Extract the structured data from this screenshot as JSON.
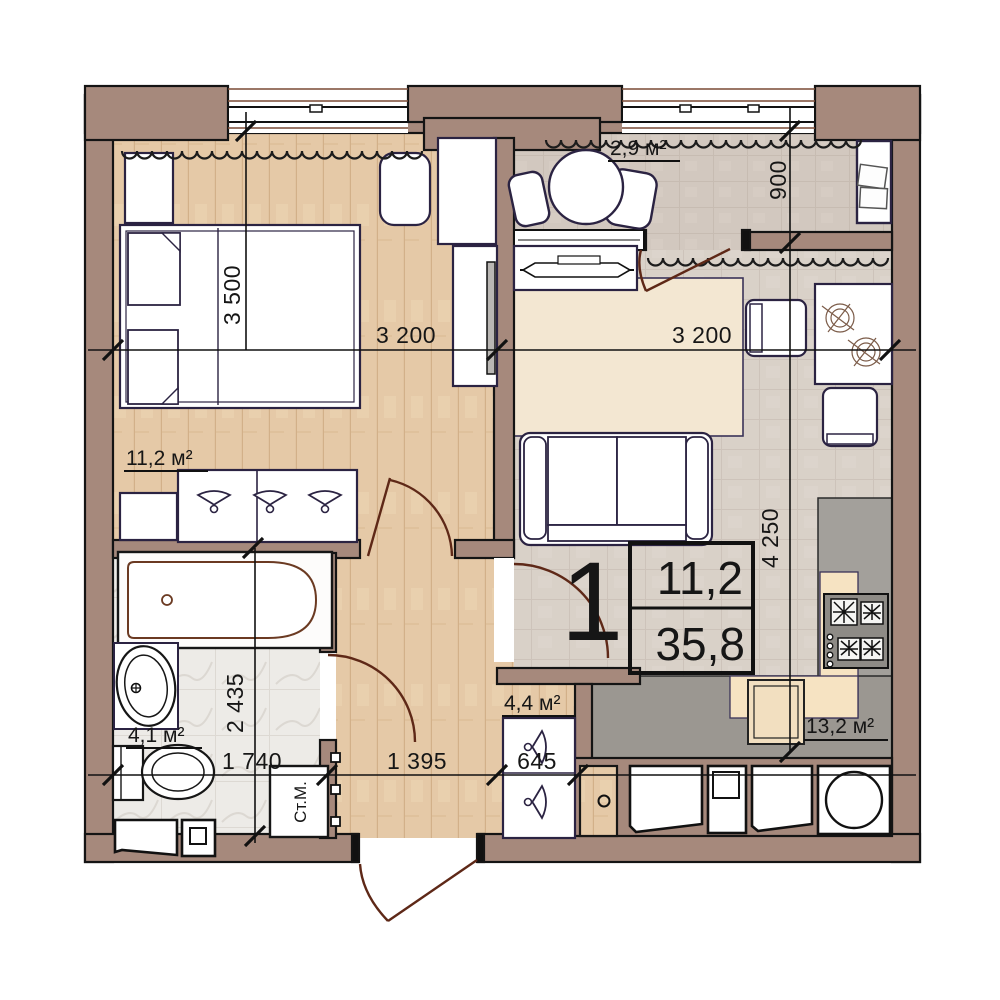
{
  "areas": {
    "bedroom": "11,2 м²",
    "balcony": "2,9 м²",
    "bathroom": "4,1 м²",
    "hallway": "4,4 м²",
    "kitchen": "13,2 м²"
  },
  "dims": {
    "bedroom_depth": "3 500",
    "bedroom_width": "3 200",
    "living_width": "3 200",
    "balcony_depth": "900",
    "kitchen_depth": "4 250",
    "bathroom_depth": "2 435",
    "bathroom_width": "1 740",
    "hallway_width": "1 395",
    "closet_width": "645"
  },
  "stamp": {
    "rooms_count": "1",
    "living_area": "11,2",
    "total_area": "35,8"
  },
  "appliances": {
    "washing_machine": "Ст.М."
  },
  "colors": {
    "wall": "#a6897c",
    "wood": "#e5c9a7",
    "tile": "#d9d1c8",
    "balcony_tile": "#d2c8bf",
    "marble": "#edebe7",
    "rug": "#f3e7d2",
    "kitchen_mat": "#f6e3c2",
    "floor_gray": "#9b9791",
    "counter_gray": "#a3a09b",
    "stove_gray": "#8e8b86",
    "door_arc": "#5e2817",
    "outline": "#161616",
    "furniture_outline": "#2b2342"
  }
}
